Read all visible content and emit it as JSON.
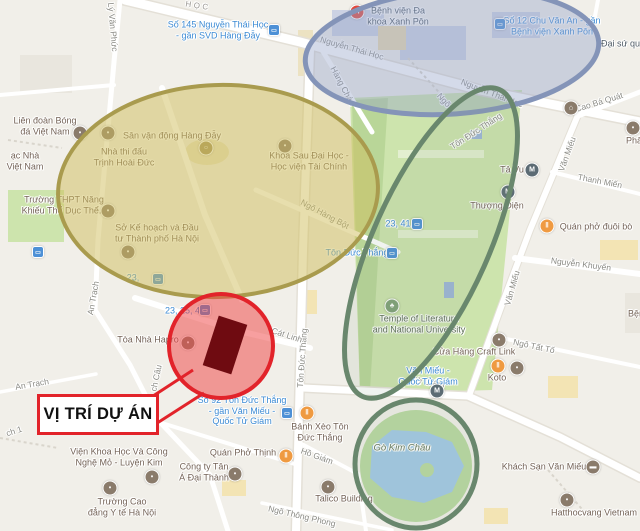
{
  "callout": {
    "label": "VỊ TRÍ DỰ ÁN"
  },
  "map": {
    "background": "#f1efe9",
    "icon_styles": {
      "hospital": {
        "bg": "#e0493d",
        "glyph": "H"
      },
      "metro": {
        "bg": "#5c6b74",
        "glyph": "M"
      },
      "food": {
        "bg": "#ef9a41",
        "glyph": "‖"
      },
      "poi": {
        "bg": "#8a7b6b",
        "glyph": "▪"
      },
      "museum": {
        "bg": "#8a7b6b",
        "glyph": "⌂"
      },
      "tree": {
        "bg": "#7fa077",
        "glyph": "♣"
      },
      "stadium": {
        "bg": "#a4935a",
        "glyph": "○"
      },
      "hotel": {
        "bg": "#8a7b6b",
        "glyph": "▬"
      },
      "bus": {
        "bg": "#4d90d6",
        "glyph": "▭",
        "shape": "square"
      }
    },
    "labels": [
      {
        "text": "Lý Văn Phức",
        "x": 113,
        "y": 27,
        "rot": 85,
        "cls": "street",
        "name": "street-ly-van-phuc"
      },
      {
        "text": "HỌC",
        "x": 198,
        "y": 6,
        "rot": 9,
        "cls": "street-caps",
        "name": "street-nguyen-thai-hoc-caps"
      },
      {
        "text": "Nguyễn Thái Học",
        "x": 352,
        "y": 48,
        "rot": 16,
        "cls": "street",
        "name": "street-nguyen-thai-hoc"
      },
      {
        "text": "Nguyễn Thái Học",
        "x": 492,
        "y": 93,
        "rot": 21,
        "cls": "street",
        "name": "street-nguyen-thai-hoc-2"
      },
      {
        "text": "Hàng Cháo",
        "x": 343,
        "y": 86,
        "rot": 62,
        "cls": "street",
        "name": "street-hang-chao"
      },
      {
        "text": "Ngõ",
        "x": 444,
        "y": 100,
        "rot": 48,
        "cls": "street",
        "name": "street-ngo"
      },
      {
        "text": "Tôn Đức Thắng",
        "x": 476,
        "y": 131,
        "rot": -33,
        "cls": "street",
        "name": "street-ton-duc-thang-ne"
      },
      {
        "text": "Cao Bá Quát",
        "x": 599,
        "y": 102,
        "rot": -17,
        "cls": "street",
        "name": "street-cao-ba-quat"
      },
      {
        "text": "Văn Miếu",
        "x": 567,
        "y": 154,
        "rot": -70,
        "cls": "street",
        "name": "street-van-mieu"
      },
      {
        "text": "Thanh Miến",
        "x": 600,
        "y": 181,
        "rot": 11,
        "cls": "street",
        "name": "street-thanh-mien"
      },
      {
        "text": "Nguyễn Khuyến",
        "x": 581,
        "y": 264,
        "rot": 7,
        "cls": "street",
        "name": "street-nguyen-khuyen"
      },
      {
        "text": "Văn Miếu",
        "x": 512,
        "y": 288,
        "rot": -74,
        "cls": "street",
        "name": "street-van-mieu-2"
      },
      {
        "text": "Ngô Tất Tố",
        "x": 534,
        "y": 346,
        "rot": 12,
        "cls": "street",
        "name": "street-ngo-tat-to"
      },
      {
        "text": "Ngõ Hàng Bột",
        "x": 325,
        "y": 214,
        "rot": 28,
        "cls": "street",
        "name": "street-ngo-hang-bot"
      },
      {
        "text": "Tôn Đức Thắng",
        "x": 302,
        "y": 358,
        "rot": -86,
        "cls": "street",
        "name": "street-ton-duc-thang"
      },
      {
        "text": "Cát Linh",
        "x": 287,
        "y": 335,
        "rot": 18,
        "cls": "street",
        "name": "street-cat-linh"
      },
      {
        "text": "An Trạch",
        "x": 93,
        "y": 298,
        "rot": -80,
        "cls": "street",
        "name": "street-an-trach"
      },
      {
        "text": "An Trạch",
        "x": 32,
        "y": 384,
        "rot": -10,
        "cls": "street",
        "name": "street-an-trach-2"
      },
      {
        "text": "ch Câu",
        "x": 156,
        "y": 378,
        "rot": -78,
        "cls": "street",
        "name": "street-bich-cau-partial"
      },
      {
        "text": "ch 1",
        "x": 14,
        "y": 431,
        "rot": -18,
        "cls": "street",
        "name": "street-alley-partial"
      },
      {
        "text": "Tử Giám",
        "x": 428,
        "y": 382,
        "rot": 8,
        "cls": "street",
        "name": "street-quoc-tu-giam-partial"
      },
      {
        "text": "Hồ Giám",
        "x": 317,
        "y": 456,
        "rot": 20,
        "cls": "street",
        "name": "street-ho-giam"
      },
      {
        "text": "Ngõ Thông Phong",
        "x": 302,
        "y": 516,
        "rot": 13,
        "cls": "street",
        "name": "street-ngo-thong-phong"
      },
      {
        "lines": [
          "Bệnh viện Đa",
          "khoa Xanh Pôn"
        ],
        "x": 398,
        "y": 16,
        "cls": "poi-dark",
        "name": "label-benh-vien-xanh-pon"
      },
      {
        "lines": [
          "Số 145 Nguyễn Thái Học",
          "- gần SVD Hàng Đẫy"
        ],
        "x": 218,
        "y": 30,
        "cls": "transit",
        "name": "label-bus-145-nguyen-thai-hoc"
      },
      {
        "lines": [
          "Số 12 Chu Văn An - gần",
          "Bệnh viện Xanh Pôn"
        ],
        "x": 552,
        "y": 26,
        "cls": "transit",
        "name": "label-bus-12-chu-van-an"
      },
      {
        "text": "Đại sứ quán",
        "x": 601,
        "y": 44,
        "cls": "poi-dark",
        "anchor": "left",
        "name": "label-dai-su-quan"
      },
      {
        "lines": [
          "Liên đoàn Bóng",
          "đá Việt Nam"
        ],
        "x": 45,
        "y": 126,
        "cls": "poi",
        "name": "label-lien-doan-bong-da"
      },
      {
        "lines": [
          "ạc Nhà",
          "Việt Nam"
        ],
        "x": 25,
        "y": 161,
        "cls": "poi",
        "name": "label-nha-viet-nam-partial"
      },
      {
        "text": "Sân vận động Hàng Đẫy",
        "x": 172,
        "y": 136,
        "cls": "poi",
        "name": "label-san-van-dong-hang-day"
      },
      {
        "lines": [
          "Nhà thi đấu",
          "Trịnh Hoài Đức"
        ],
        "x": 124,
        "y": 157,
        "cls": "poi",
        "name": "label-nha-thi-dau"
      },
      {
        "lines": [
          "Trường THPT Năng",
          "Khiếu Thể Dục Thể..."
        ],
        "x": 64,
        "y": 205,
        "cls": "poi",
        "name": "label-truong-thpt-nang-khieu"
      },
      {
        "lines": [
          "Sở Kế hoạch và Đầu",
          "tư Thành phố Hà Nội"
        ],
        "x": 157,
        "y": 233,
        "cls": "poi",
        "name": "label-so-ke-hoach-dau-tu"
      },
      {
        "lines": [
          "Khoa Sau Đại Học -",
          "Học viện Tài Chính"
        ],
        "x": 309,
        "y": 161,
        "cls": "poi",
        "name": "label-khoa-sau-dai-hoc"
      },
      {
        "text": "Tả Vu",
        "x": 512,
        "y": 170,
        "cls": "poi",
        "name": "label-ta-vu"
      },
      {
        "text": "Thượng Điện",
        "x": 497,
        "y": 206,
        "cls": "poi",
        "name": "label-thuong-dien"
      },
      {
        "text": "Quán phở đuôi bò",
        "x": 596,
        "y": 227,
        "cls": "poi",
        "name": "label-quan-pho-duoi-bo"
      },
      {
        "text": "Phẩm",
        "x": 626,
        "y": 141,
        "cls": "poi",
        "anchor": "left",
        "name": "label-pham-partial"
      },
      {
        "text": "Bện",
        "x": 628,
        "y": 314,
        "cls": "poi",
        "anchor": "left",
        "name": "label-benh-partial"
      },
      {
        "lines": [
          "Temple of Literature",
          "and National University"
        ],
        "x": 419,
        "y": 324,
        "cls": "park-poi",
        "name": "label-temple-of-literature"
      },
      {
        "text": "Cửa Hàng Craft Link",
        "x": 474,
        "y": 352,
        "cls": "poi",
        "name": "label-craft-link"
      },
      {
        "text": "Koto",
        "x": 497,
        "y": 378,
        "cls": "poi",
        "name": "label-koto"
      },
      {
        "lines": [
          "Văn Miếu -",
          "Quốc Tử Giám"
        ],
        "x": 428,
        "y": 376,
        "cls": "transit",
        "name": "label-van-mieu-quoc-tu-giam"
      },
      {
        "text": "Tòa Nhà Hapro",
        "x": 148,
        "y": 340,
        "cls": "poi",
        "name": "label-toa-nha-hapro"
      },
      {
        "text": "23, 25, 49",
        "x": 185,
        "y": 311,
        "cls": "transit",
        "name": "label-bus-23-25-49"
      },
      {
        "text": "23,",
        "x": 133,
        "y": 278,
        "cls": "transit",
        "name": "label-bus-23-partial"
      },
      {
        "text": "23, 41",
        "x": 398,
        "y": 224,
        "cls": "transit",
        "name": "label-bus-23-41"
      },
      {
        "text": "Tôn Đức Thắng",
        "x": 357,
        "y": 253,
        "cls": "transit",
        "name": "label-bus-stop-ton-duc-thang"
      },
      {
        "lines": [
          "Số 92 Tôn Đức Thắng",
          "- gần Văn Miếu -",
          "Quốc Tử Giám"
        ],
        "x": 242,
        "y": 411,
        "cls": "transit",
        "name": "label-bus-92-ton-duc-thang"
      },
      {
        "lines": [
          "Bánh Xèo Tôn",
          "Đức Thắng"
        ],
        "x": 320,
        "y": 432,
        "cls": "poi",
        "name": "label-banh-xeo"
      },
      {
        "text": "Quán Phở Thịnh",
        "x": 243,
        "y": 453,
        "cls": "poi",
        "name": "label-quan-pho-thinh"
      },
      {
        "text": "Gò Kim Châu",
        "x": 402,
        "y": 448,
        "cls": "park",
        "name": "label-go-kim-chau"
      },
      {
        "lines": [
          "Viện Khoa Học Và Công",
          "Nghệ Mỏ - Luyện Kim"
        ],
        "x": 119,
        "y": 457,
        "cls": "poi",
        "name": "label-vien-khoa-hoc"
      },
      {
        "lines": [
          "Công ty Tân",
          "Á Đại Thành"
        ],
        "x": 204,
        "y": 472,
        "cls": "poi",
        "name": "label-cong-ty-tan-a"
      },
      {
        "lines": [
          "Trường Cao",
          "đẳng Y tế Hà Nội"
        ],
        "x": 122,
        "y": 507,
        "cls": "poi",
        "name": "label-truong-cao-dang-y-te"
      },
      {
        "text": "Talico Building",
        "x": 344,
        "y": 499,
        "cls": "poi",
        "name": "label-talico-building"
      },
      {
        "text": "Khách Sạn Văn Miếu",
        "x": 544,
        "y": 467,
        "cls": "poi",
        "name": "label-khach-san-van-mieu"
      },
      {
        "text": "Hatthocvang Vietnam",
        "x": 594,
        "y": 513,
        "cls": "poi",
        "name": "label-hatthocvang"
      }
    ],
    "icons": [
      {
        "type": "hospital",
        "x": 357,
        "y": 12
      },
      {
        "type": "bus",
        "x": 274,
        "y": 30
      },
      {
        "type": "bus",
        "x": 500,
        "y": 24
      },
      {
        "type": "poi",
        "x": 80,
        "y": 133
      },
      {
        "type": "stadium",
        "x": 206,
        "y": 148
      },
      {
        "type": "poi",
        "x": 108,
        "y": 133
      },
      {
        "type": "poi",
        "x": 108,
        "y": 211
      },
      {
        "type": "poi",
        "x": 128,
        "y": 252
      },
      {
        "type": "poi",
        "x": 285,
        "y": 146
      },
      {
        "type": "metro",
        "x": 532,
        "y": 170
      },
      {
        "type": "metro",
        "x": 508,
        "y": 192
      },
      {
        "type": "food",
        "x": 547,
        "y": 226
      },
      {
        "type": "museum",
        "x": 571,
        "y": 108
      },
      {
        "type": "poi",
        "x": 633,
        "y": 128
      },
      {
        "type": "bus",
        "x": 417,
        "y": 224
      },
      {
        "type": "bus",
        "x": 392,
        "y": 253
      },
      {
        "type": "bus",
        "x": 158,
        "y": 279
      },
      {
        "type": "bus",
        "x": 205,
        "y": 310
      },
      {
        "type": "poi",
        "x": 188,
        "y": 343
      },
      {
        "type": "bus",
        "x": 38,
        "y": 252
      },
      {
        "type": "bus",
        "x": 287,
        "y": 413
      },
      {
        "type": "tree",
        "x": 392,
        "y": 306
      },
      {
        "type": "metro",
        "x": 437,
        "y": 391
      },
      {
        "type": "poi",
        "x": 499,
        "y": 340
      },
      {
        "type": "food",
        "x": 498,
        "y": 366
      },
      {
        "type": "poi",
        "x": 517,
        "y": 368
      },
      {
        "type": "food",
        "x": 307,
        "y": 413
      },
      {
        "type": "food",
        "x": 286,
        "y": 456
      },
      {
        "type": "poi",
        "x": 235,
        "y": 474
      },
      {
        "type": "poi",
        "x": 152,
        "y": 477
      },
      {
        "type": "poi",
        "x": 110,
        "y": 488
      },
      {
        "type": "hotel",
        "x": 593,
        "y": 467
      },
      {
        "type": "poi",
        "x": 567,
        "y": 500
      },
      {
        "type": "poi",
        "x": 328,
        "y": 487
      }
    ],
    "overlays": {
      "ellipses": [
        {
          "name": "highlight-ellipse-stadium-olive",
          "cx": 218,
          "cy": 191,
          "rx": 160,
          "ry": 106,
          "rot": -2,
          "fill": "rgba(207,190,92,0.50)",
          "stroke": "#a99b4e",
          "sw": 4
        },
        {
          "name": "highlight-ellipse-hospital-blue",
          "cx": 452,
          "cy": 52,
          "rx": 147,
          "ry": 62,
          "rot": -4,
          "fill": "rgba(148,162,200,0.40)",
          "stroke": "#8494b8",
          "sw": 5
        },
        {
          "name": "highlight-ellipse-temple-green",
          "cx": 431,
          "cy": 243,
          "rx": 58,
          "ry": 168,
          "rot": 24,
          "fill": "rgba(130,160,130,0.12)",
          "stroke": "#69876d",
          "sw": 5
        },
        {
          "name": "highlight-ellipse-lake-green",
          "cx": 416,
          "cy": 464,
          "rx": 61,
          "ry": 64,
          "rot": 0,
          "fill": "rgba(130,160,130,0.10)",
          "stroke": "#69876d",
          "sw": 5
        },
        {
          "name": "highlight-circle-project-red",
          "cx": 221,
          "cy": 346,
          "rx": 52,
          "ry": 52,
          "rot": 0,
          "fill": "rgba(240,70,70,0.52)",
          "stroke": "#e2232a",
          "sw": 4
        }
      ],
      "marker": {
        "cx": 225,
        "cy": 345,
        "w": 30,
        "h": 52,
        "rot": 18,
        "fill": "#6f0b11"
      },
      "pointer_lines": [
        [
          150,
          398,
          193,
          370
        ],
        [
          151,
          427,
          204,
          393
        ]
      ],
      "pointer_color": "#e2232a"
    }
  }
}
